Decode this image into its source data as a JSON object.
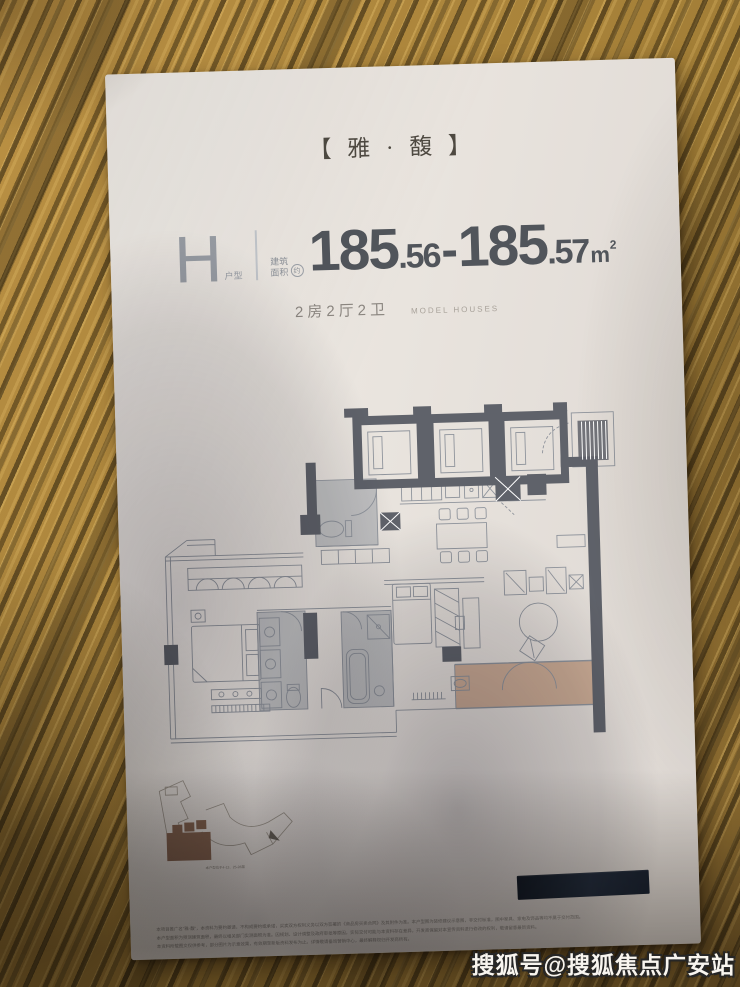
{
  "photo": {
    "watermark": "搜狐号@搜狐焦点广安站"
  },
  "flyer": {
    "brand_title": "【 雅 · 馥 】",
    "unit": {
      "code": "H",
      "code_label": "户型",
      "area_prefix_line1": "建筑",
      "area_prefix_line2": "面积",
      "area_prefix_approx": "约",
      "area_int1": "185",
      "area_dec1": ".56",
      "area_dash": "-",
      "area_int2": "185",
      "area_dec2": ".57",
      "area_unit": "m",
      "area_unit_sup": "2",
      "area_full": "185.56-185.57m²"
    },
    "layout_spec": "2房2厅2卫",
    "layout_spec_en": "MODEL HOUSES",
    "keyplan": {
      "caption": "本户型位于4-12、25-28层"
    },
    "legal": {
      "line1": "本项目推广名\"雅·馥\"，本资料为要约邀请，不构成要约或承诺，买卖双方权利义务以双方签署的《商品房买卖合同》及其附件为准。本户型图为装修建议示意图，非交付标准，图中家具、家电及饰品等均不属于交付范围。",
      "line2": "本户型面积为预测建筑面积，最终以相关部门实测面积为准。因规划、设计调整及政府审批等原因，实际交付可能与本资料存在差异，开发商保留对本宣传资料进行修改的权利，敬请留意最新资料。",
      "line3": "本资料所载图文仅供参考，部分图片为示意效果，有效期至新版资料发布为止。详情敬请垂询营销中心，最终解释权归开发商所有。"
    }
  },
  "colors": {
    "wood_light": "#bb9144",
    "wood_dark": "#6e592f",
    "paper": "#e9e4de",
    "plan_wall": "#5f626a",
    "plan_line": "#8f949c",
    "bathroom_fill": "#9196a0",
    "balcony_fill": "#c9a68e",
    "keyplan_unit": "#8d6a55",
    "number_text": "#51555b",
    "navy_bar": "#1c2330"
  }
}
